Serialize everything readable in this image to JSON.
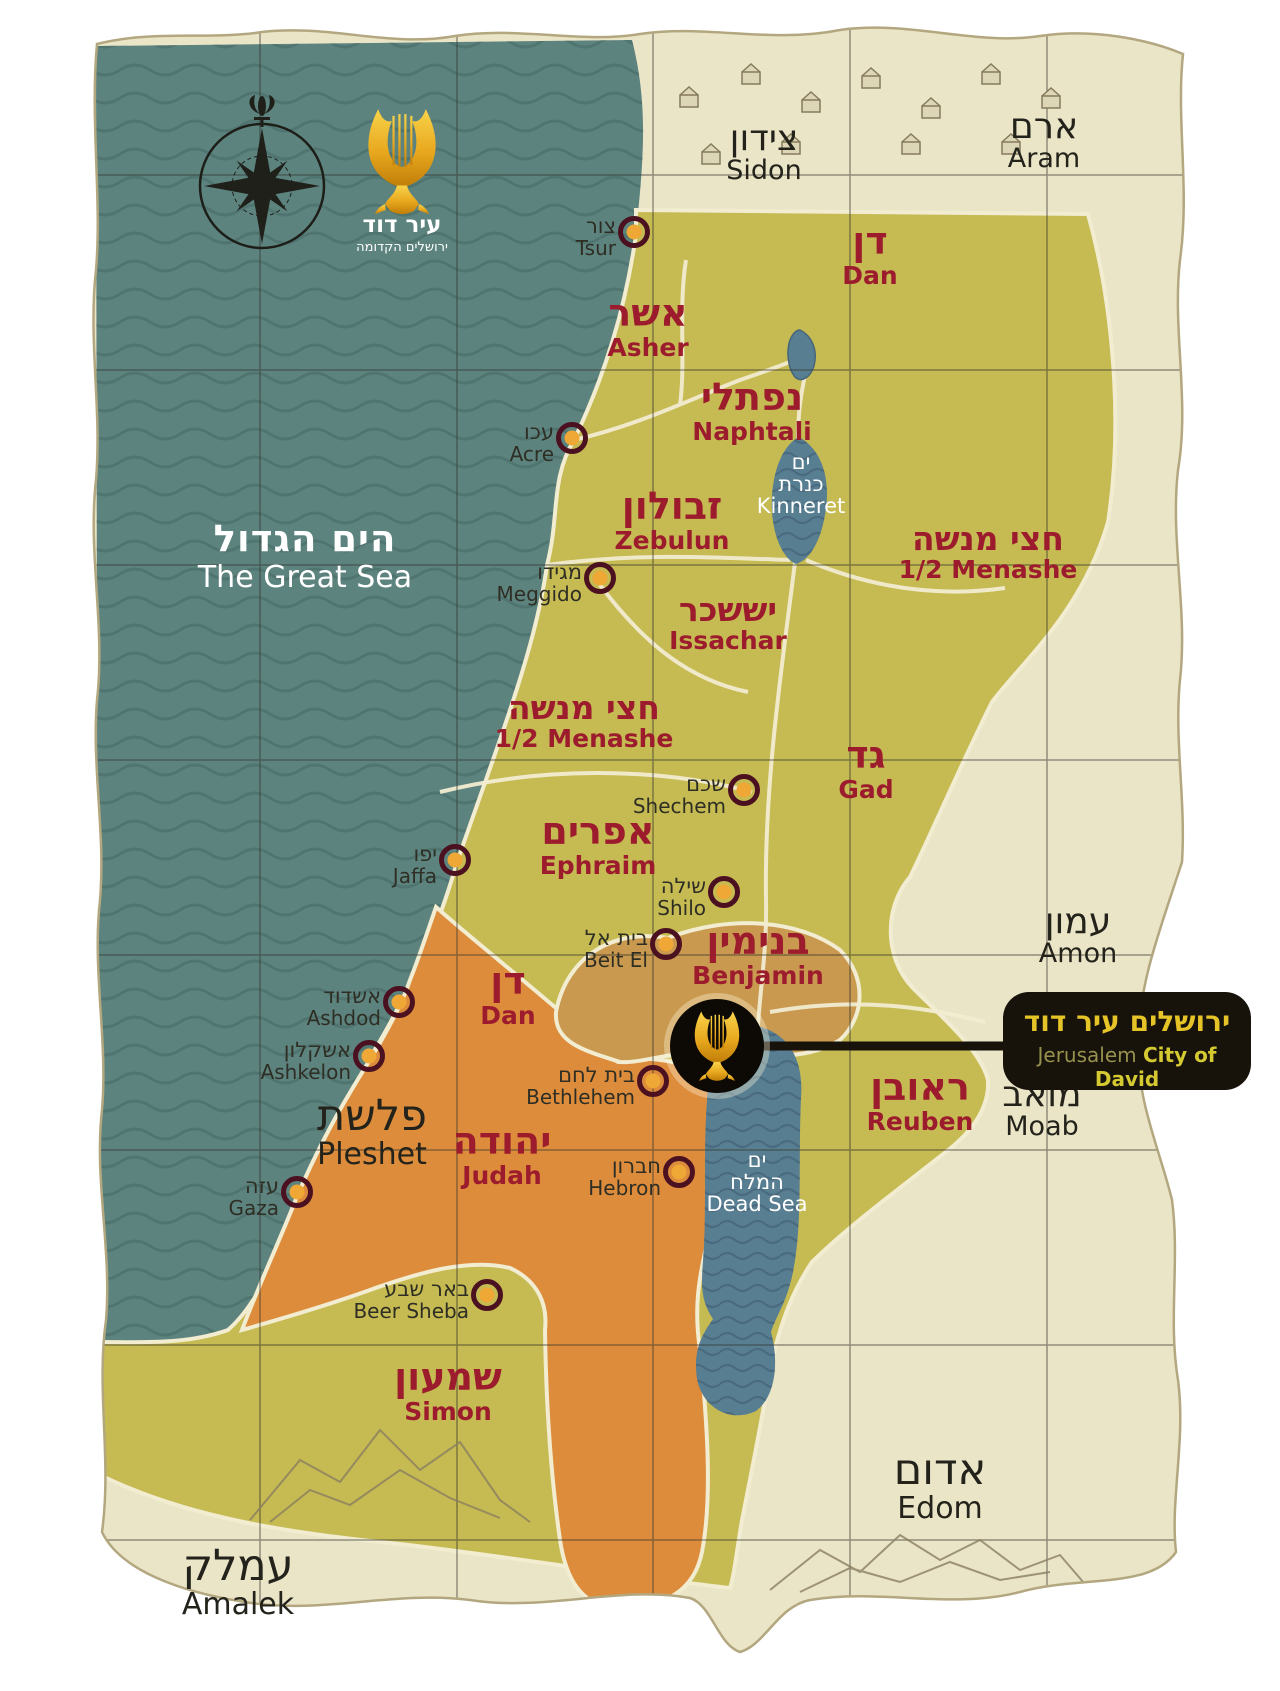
{
  "logo": {
    "line1": "עיר דוד",
    "line2": "ירושלים הקדומה"
  },
  "sea": {
    "he": "הים הגדול",
    "en": "The Great Sea"
  },
  "lakes": {
    "kinneret": {
      "he1": "ים",
      "he2": "כנרת",
      "en": "Kinneret"
    },
    "dead_sea": {
      "he1": "ים",
      "he2": "המלח",
      "en": "Dead Sea"
    }
  },
  "tribes": [
    {
      "id": "dan-north",
      "he": "דן",
      "en": "Dan"
    },
    {
      "id": "asher",
      "he": "אשר",
      "en": "Asher"
    },
    {
      "id": "naphtali",
      "he": "נפתלי",
      "en": "Naphtali"
    },
    {
      "id": "zebulun",
      "he": "זבולון",
      "en": "Zebulun"
    },
    {
      "id": "menashe-east",
      "he": "חצי מנשה",
      "en": "1/2 Menashe"
    },
    {
      "id": "issachar",
      "he": "יששכר",
      "en": "Issachar"
    },
    {
      "id": "menashe-west",
      "he": "חצי מנשה",
      "en": "1/2 Menashe"
    },
    {
      "id": "gad",
      "he": "גד",
      "en": "Gad"
    },
    {
      "id": "ephraim",
      "he": "אפרים",
      "en": "Ephraim"
    },
    {
      "id": "benjamin",
      "he": "בנימין",
      "en": "Benjamin"
    },
    {
      "id": "dan-south",
      "he": "דן",
      "en": "Dan"
    },
    {
      "id": "reuben",
      "he": "ראובן",
      "en": "Reuben"
    },
    {
      "id": "judah",
      "he": "יהודה",
      "en": "Judah"
    },
    {
      "id": "simon",
      "he": "שמעון",
      "en": "Simon"
    }
  ],
  "neighbors": [
    {
      "id": "sidon",
      "he": "צידון",
      "en": "Sidon"
    },
    {
      "id": "aram",
      "he": "ארם",
      "en": "Aram"
    },
    {
      "id": "amon",
      "he": "עמון",
      "en": "Amon"
    },
    {
      "id": "moab",
      "he": "מואב",
      "en": "Moab"
    },
    {
      "id": "edom",
      "he": "אדום",
      "en": "Edom"
    },
    {
      "id": "amalek",
      "he": "עמלק",
      "en": "Amalek"
    },
    {
      "id": "pleshet",
      "he": "פלשת",
      "en": "Pleshet"
    }
  ],
  "cities": [
    {
      "id": "tsur",
      "he": "צור",
      "en": "Tsur"
    },
    {
      "id": "acre",
      "he": "עכו",
      "en": "Acre"
    },
    {
      "id": "meggido",
      "he": "מגידו",
      "en": "Meggido"
    },
    {
      "id": "shechem",
      "he": "שכם",
      "en": "Shechem"
    },
    {
      "id": "jaffa",
      "he": "יפו",
      "en": "Jaffa"
    },
    {
      "id": "shilo",
      "he": "שילה",
      "en": "Shilo"
    },
    {
      "id": "beit-el",
      "he": "בית אל",
      "en": "Beit El"
    },
    {
      "id": "ashdod",
      "he": "אשדוד",
      "en": "Ashdod"
    },
    {
      "id": "ashkelon",
      "he": "אשקלון",
      "en": "Ashkelon"
    },
    {
      "id": "bethlehem",
      "he": "בית לחם",
      "en": "Bethlehem"
    },
    {
      "id": "hebron",
      "he": "חברון",
      "en": "Hebron"
    },
    {
      "id": "gaza",
      "he": "עזה",
      "en": "Gaza"
    },
    {
      "id": "beer-sheba",
      "he": "באר שבע",
      "en": "Beer Sheba"
    }
  ],
  "jerusalem": {
    "he": "ירושלים עיר דוד",
    "en_regular": "Jerusalem",
    "en_bold": "City of David"
  },
  "colors": {
    "sea": "#5d837f",
    "sea_wave": "#4a6f6a",
    "land": "#c6ba52",
    "orange": "#dd8c3c",
    "benjamin_tan": "#c9994f",
    "parchment": "#ebe5c8",
    "lake": "#587e92",
    "tribe_red": "#9c1c2e",
    "cream_border": "#f2ecd1",
    "marker_ring": "#4b1120",
    "marker_fill": "#efa735",
    "callout_bg": "#17130b",
    "callout_gold": "#e6c427"
  }
}
